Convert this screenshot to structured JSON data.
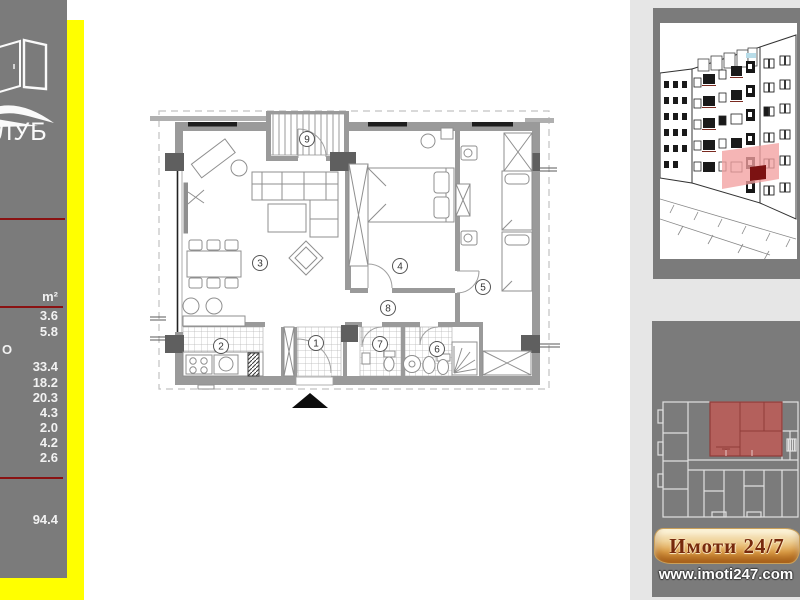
{
  "sidebar": {
    "logo_fragment": "ЛУБ",
    "table": {
      "unit_header": "m²",
      "cut_label": "О",
      "values": [
        "3.6",
        "5.8",
        "33.4",
        "18.2",
        "20.3",
        "4.3",
        "2.0",
        "4.2",
        "2.6"
      ],
      "total": "94.4"
    }
  },
  "plan": {
    "rooms": [
      {
        "label": "1"
      },
      {
        "label": "2"
      },
      {
        "label": "3"
      },
      {
        "label": "4"
      },
      {
        "label": "5"
      },
      {
        "label": "6"
      },
      {
        "label": "7"
      },
      {
        "label": "8"
      },
      {
        "label": "9"
      }
    ]
  },
  "footer": {
    "brand": "Имоти 24/7",
    "website": "www.imoti247.com"
  },
  "colors": {
    "sidebar_gray": "#7b7b7b",
    "accent_yellow": "#ffff00",
    "divider_red": "#8a1212",
    "elevation_highlight_pink": "#f2a0a0",
    "overview_highlight_red": "#b4605c"
  }
}
